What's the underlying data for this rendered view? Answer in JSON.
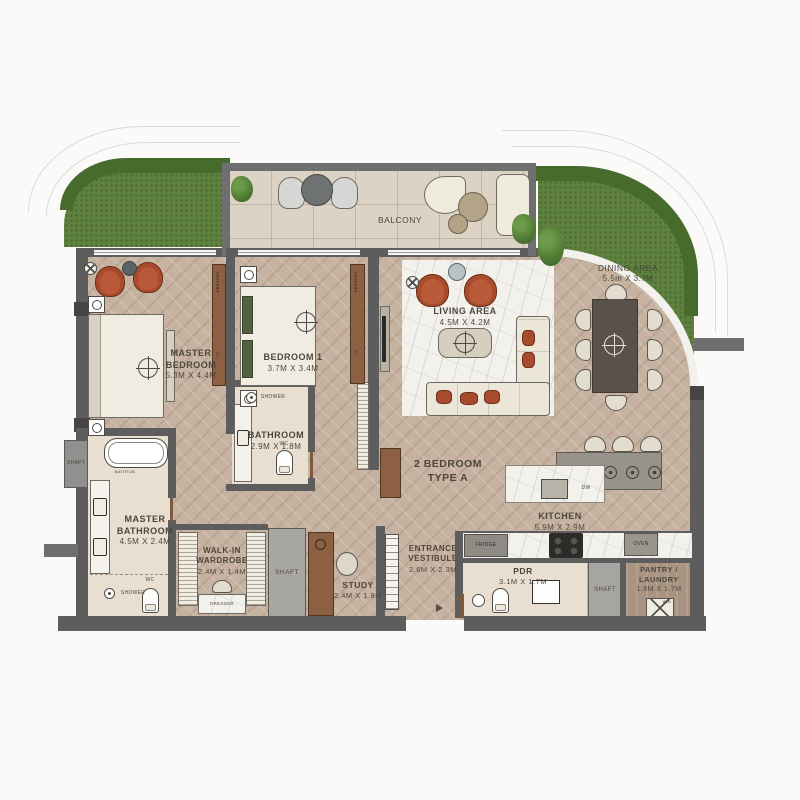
{
  "plan": {
    "unit_type_line1": "2 BEDROOM",
    "unit_type_line2": "TYPE A"
  },
  "rooms": {
    "balcony": {
      "name": "BALCONY"
    },
    "master_bedroom": {
      "name": "MASTER BEDROOM",
      "dims": "5.3M X 4.4M"
    },
    "bedroom_1": {
      "name": "BEDROOM 1",
      "dims": "3.7M X 3.4M"
    },
    "bathroom": {
      "name": "BATHROOM",
      "dims": "2.9M X 1.8M"
    },
    "living_area": {
      "name": "LIVING AREA",
      "dims": "4.5M X 4.2M"
    },
    "dining_area": {
      "name": "DINING AREA",
      "dims": "5.5m X 3.7M"
    },
    "kitchen": {
      "name": "KITCHEN",
      "dims": "5.9M X 2.9M"
    },
    "master_bathroom": {
      "name": "MASTER BATHROOM",
      "dims": "4.5M X 2.4M"
    },
    "walk_in_wardrobe": {
      "name": "WALK-IN WARDROBE",
      "dims": "2.4M X 1.4M"
    },
    "study": {
      "name": "STUDY",
      "dims": "2.4M X 1.8M"
    },
    "entrance_vestibule": {
      "name": "ENTRANCE VESTIBULE",
      "dims": "2.6M X 2.3M"
    },
    "pdr": {
      "name": "PDR",
      "dims": "3.1M X 1.7M"
    },
    "pantry_laundry": {
      "name": "PANTRY / LAUNDRY",
      "dims": "1.8M X 1.7M"
    }
  },
  "shafts": [
    "SHAFT",
    "SHAFT",
    "SHAFT"
  ],
  "fixtures": {
    "bathtub": "BATHTUB",
    "shower_master": "SHOWER",
    "shower_bathroom": "SHOWER",
    "wc_master": "WC",
    "wc_bathroom": "WC",
    "dresser_master": "DRESSER",
    "dresser_bedroom_1": "DRESSER",
    "dresser_wardrobe": "DRESSER",
    "tv_master": "TV",
    "tv_bedroom_1": "TV",
    "fridge": "FRIDGE",
    "dishwasher": "DW",
    "oven": "OVEN",
    "washer_dryer": "W/D"
  },
  "colors": {
    "wall": "#5d5d5d",
    "wood_floor": "#c6b2a0",
    "balcony_tile": "#dcd3c4",
    "bathroom_floor": "#e9dfd0",
    "lawn": "#5e8140",
    "hedge": "#466b2c",
    "accent_chair": "#a84b2d",
    "cabinet_brown": "#8d6044",
    "marble": "#f3f1ec",
    "label_text": "#4d463d"
  }
}
